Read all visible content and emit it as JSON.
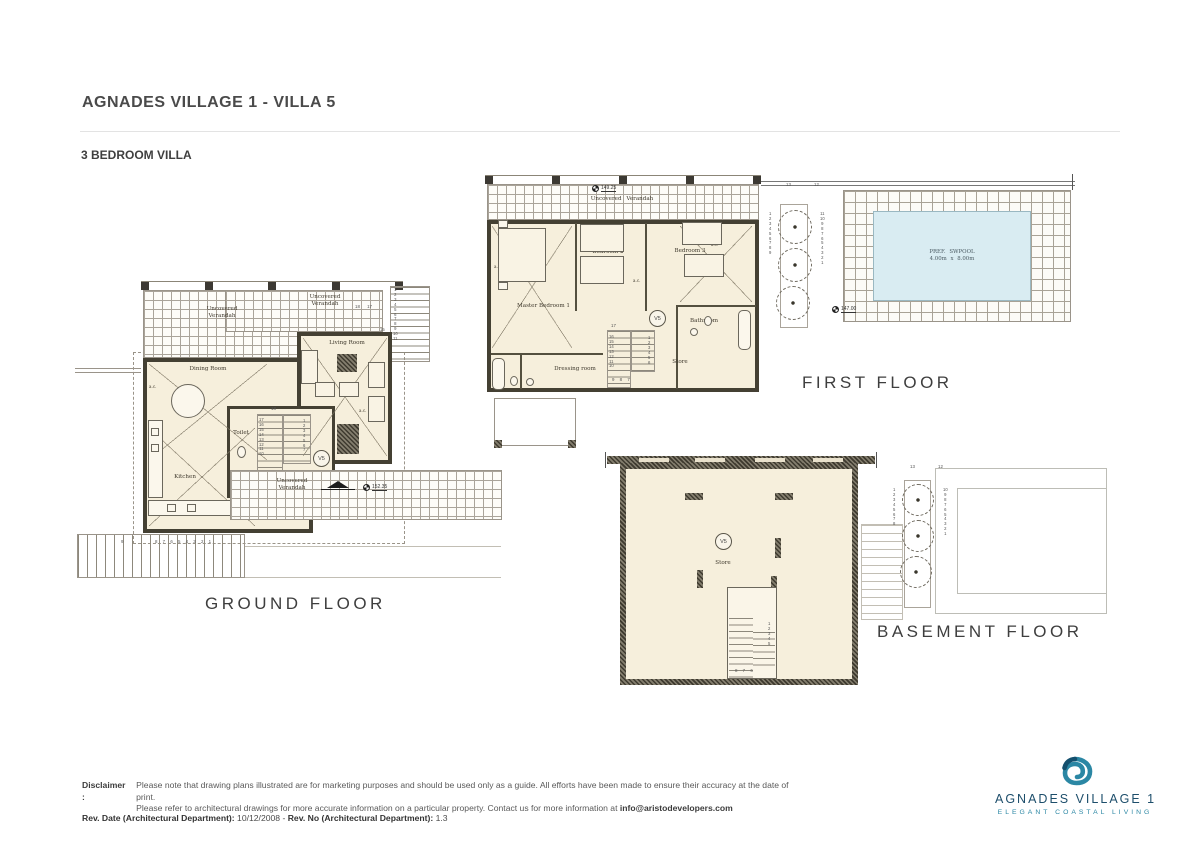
{
  "colors": {
    "floor_fill": "#f6efdc",
    "wall": "#444033",
    "pool_fill": "#d9ecf2",
    "grid_line": "#a8a195",
    "logo_navy": "#1d4e6b",
    "logo_teal": "#2b87a4"
  },
  "header": {
    "title": "AGNADES VILLAGE 1 - VILLA 5",
    "subtitle": "3 BEDROOM VILLA"
  },
  "ground": {
    "floor_label": "GROUND FLOOR",
    "verandah_top_left": "Uncovered\nVerandah",
    "verandah_top_right": "Uncovered\nVerandah",
    "verandah_bottom": "Uncovered\nVerandah",
    "dining": "Dining Room",
    "living": "Living Room",
    "kitchen": "Kitchen",
    "toilet": "Toilet",
    "unit": "V5",
    "level": "152.35",
    "ac_left": "a.c.",
    "ac_right": "a.c.",
    "stair_top": "18",
    "stair_left_col": "17\n16\n15\n14\n13\n12\n11\n10",
    "stair_right_col": "1\n2\n3\n4\n5\n6\n7",
    "stair_bottom": "10 9 8 7",
    "ext_stair_pair": "18 17",
    "ext_stair_col": "1\n2\n3\n4\n5\n6\n7\n8\n9\n10\n11",
    "ext_stair_col2": "15\n14\n13\n12",
    "bottom_stair_nine": "9",
    "bottom_stair_nums": "8 7 6 5 4 3 2 1"
  },
  "first": {
    "floor_label": "FIRST FLOOR",
    "verandah": "Uncovered Verandah",
    "verandah_level": "149.25",
    "master": "Master Bedroom 1",
    "bedroom2": "Bedroom 2",
    "bedroom3": "Bedroom 3",
    "bathroom": "Bathroom",
    "dressing": "Dressing room",
    "store": "Store",
    "unit": "V5",
    "ac_master": "a.c.",
    "ac_center": "a.c.",
    "ac_bed3": "a.c.",
    "stair_top": "17",
    "stair_left_col": "16\n15\n14\n13\n12\n11\n10",
    "stair_right_col": "1\n2\n3\n4\n5\n6",
    "stair_bottom": "9 8 7",
    "garden_stair_13": "13",
    "garden_stair_12": "12",
    "garden_col_left": "1\n2\n3\n4\n5\n6\n7\n8\n9",
    "garden_col_right": "11\n10\n9\n8\n7\n6\n5\n4\n3\n2\n1",
    "pool_line1": "PREF. SWPOOL",
    "pool_line2": "4.00m x 8.00m",
    "pool_level": "147.00"
  },
  "basement": {
    "floor_label": "BASEMENT FLOOR",
    "store": "Store",
    "unit": "V5",
    "stair_col": "1\n2\n3\n4\n5",
    "stair_bottom": "8 7 6",
    "garden_stair_13": "13",
    "garden_stair_12": "12",
    "garden_col_left": "1\n2\n3\n4\n5\n6\n7\n8",
    "garden_col_right": "10\n9\n8\n7\n6\n5\n4\n3\n2\n1"
  },
  "footer": {
    "disclaimer_label": "Disclaimer :",
    "line1": "Please note that drawing plans illustrated are for marketing purposes and should be used only as a guide. All efforts have been made to ensure their accuracy at the date of print.",
    "line2_pre": "Please refer to architectural drawings for more accurate information on a particular property. Contact us for more information at",
    "email": "info@aristodevelopers.com",
    "rev_date_label": "Rev. Date (Architectural Department):",
    "rev_date": "10/12/2008",
    "rev_sep": "-",
    "rev_no_label": "Rev. No (Architectural Department):",
    "rev_no": "1.3"
  },
  "logo": {
    "name": "AGNADES VILLAGE 1",
    "tagline": "ELEGANT COASTAL LIVING"
  }
}
